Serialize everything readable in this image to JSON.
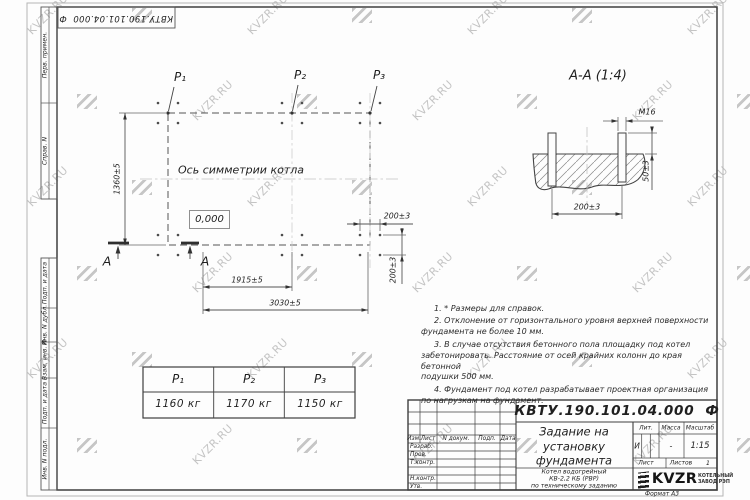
{
  "doc_number": "КВТУ.190.101.04.000  Ф",
  "side_panel": {
    "labels": [
      "Перв. примен.",
      "Справ. N",
      "Подп. и дата",
      "Инв. N дубл.",
      "Взам. инв. N",
      "Подп. и дата",
      "Инв. N подл."
    ]
  },
  "plan": {
    "p_labels": [
      "P₁",
      "P₂",
      "P₃"
    ],
    "axis_label": "Ось симметрии котла",
    "elevation": "0,000",
    "dim_height": "1360±5",
    "dim_mid": "1915±5",
    "dim_total": "3030±5",
    "dim_bolt_h": "200±3",
    "dim_bolt_v": "200±3",
    "section_letter_left": "А",
    "section_letter_right": "А"
  },
  "section": {
    "title": "А-А (1:4)",
    "thread_label": "M16",
    "dim_spacing": "200±3",
    "dim_protrusion": "50±3"
  },
  "notes": [
    "1. * Размеры для справок.",
    "2. Отклонение от горизонтального уровня верхней поверхности\nфундамента не более 10 мм.",
    "3. В случае отсутствия бетонного пола площадку под котел\nзабетонировать. Расстояние от осей крайних колонн до края бетонной\nподушки 500 мм.",
    "4. Фундамент под котел разрабатывает проектная организация\nпо нагрузкам на фундамент."
  ],
  "load_table": {
    "headers": [
      "P₁",
      "P₂",
      "P₃"
    ],
    "values": [
      "1160 кг",
      "1170 кг",
      "1150 кг"
    ]
  },
  "title_block": {
    "doc_number": "КВТУ.190.101.04.000  Ф",
    "title": "Задание на\nустановку\nфундамента",
    "product": "Котел водогрейный\nКВ-2,2 КБ (РВР)\nпо техническому заданию",
    "columns": [
      "Изм.",
      "Лист",
      "N докум.",
      "Подп.",
      "Дата"
    ],
    "rows": [
      "Разраб.",
      "Пров.",
      "Т.контр.",
      "Н.контр.",
      "Утв."
    ],
    "lit_label": "Лит.",
    "mass_label": "Масса",
    "scale_label": "Масштаб",
    "lit_value": "И",
    "mass_value": "-",
    "scale_value": "1:15",
    "sheet_label": "Лист",
    "sheets_label": "Листов",
    "sheets_value": "1",
    "logo_text": "KVZR",
    "logo_caption": "КОТЕЛЬНЫЙ\nЗАВОД РЭП",
    "format_label": "Формат А3"
  },
  "watermark": {
    "text": "KVZR.RU"
  }
}
